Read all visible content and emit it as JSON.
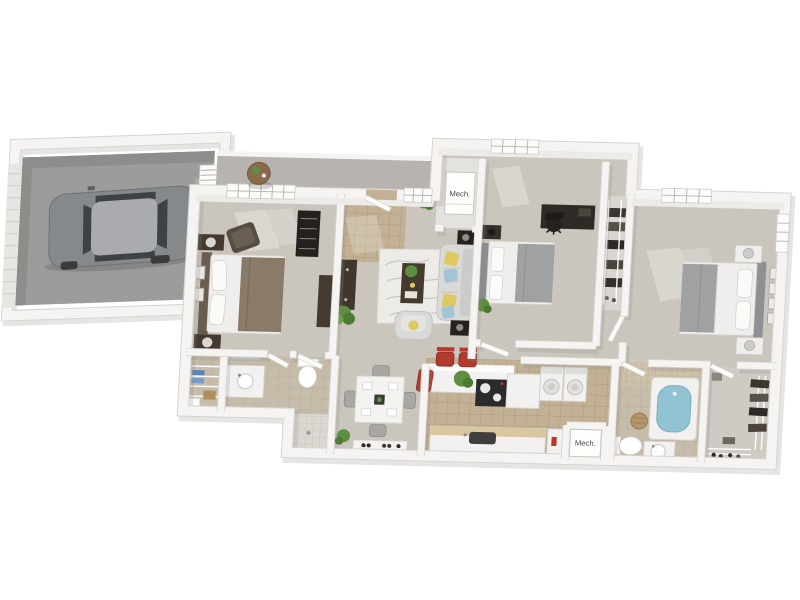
{
  "meta": {
    "description": "3D rendered apartment floor plan with attached one-car garage"
  },
  "labels": {
    "mech_closet_top": "Mech.",
    "mech_closet_bottom": "Mech."
  },
  "colors": {
    "wall": "#f5f4f2",
    "wall_edge": "#d7d4d0",
    "wall_shadow": "#8f8a83",
    "wall_face": "#edebe8",
    "carpet": "#cbc6bd",
    "tile": "#c2b194",
    "tile_light": "#cdc1a9",
    "bath_tile": "#c6bcaa",
    "garage_floor": "#9c9c9a",
    "garage_shadow": "#8d8d8b",
    "porch": "#b7b4af",
    "car_body": "#86898c",
    "car_roof": "#a9abae",
    "car_glass": "#3e4145",
    "dark_wood": "#453a30",
    "black": "#24211e",
    "sofa": "#d9dad8",
    "rug": "#edebe7",
    "pillow_yellow": "#ddc95f",
    "pillow_blue": "#a5c4d3",
    "accent_red": "#b23a2e",
    "plant": "#5e8e40",
    "plant_dark": "#4c7a33",
    "tub_blue": "#92c3d2",
    "towel_blue": "#5d82b4",
    "wood_counter": "#d9c79f",
    "bed_brown": "#8a7a68",
    "bed_gray": "#a0a1a3",
    "appliance": "#f2f1ef",
    "closet_floor": "#d9d6d1",
    "label": "#4a4845"
  }
}
